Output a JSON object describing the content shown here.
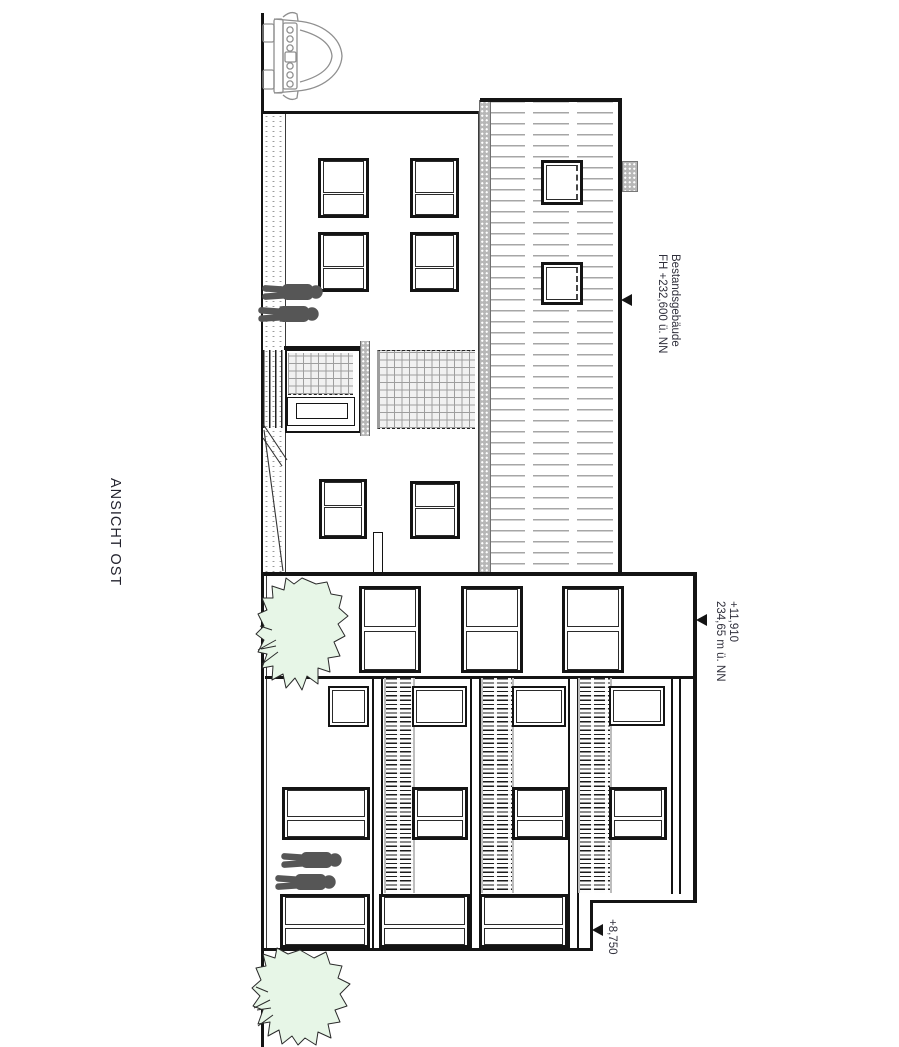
{
  "drawing": {
    "title": "ANSICHT OST",
    "annotations": {
      "existing_building": {
        "name": "Bestandsgebäude",
        "level": "FH +232,600 ü. NN"
      },
      "new_building_parapet": {
        "level": "+11,910",
        "elevation": "234,65 m ü. NN"
      },
      "side_step": {
        "level": "+8,750"
      }
    },
    "colors": {
      "line": "#141414",
      "hatch_gray": "#a6a6a6",
      "tree_fill": "#e7f6e7",
      "figure_gray": "#565656",
      "text": "#30303c"
    }
  }
}
